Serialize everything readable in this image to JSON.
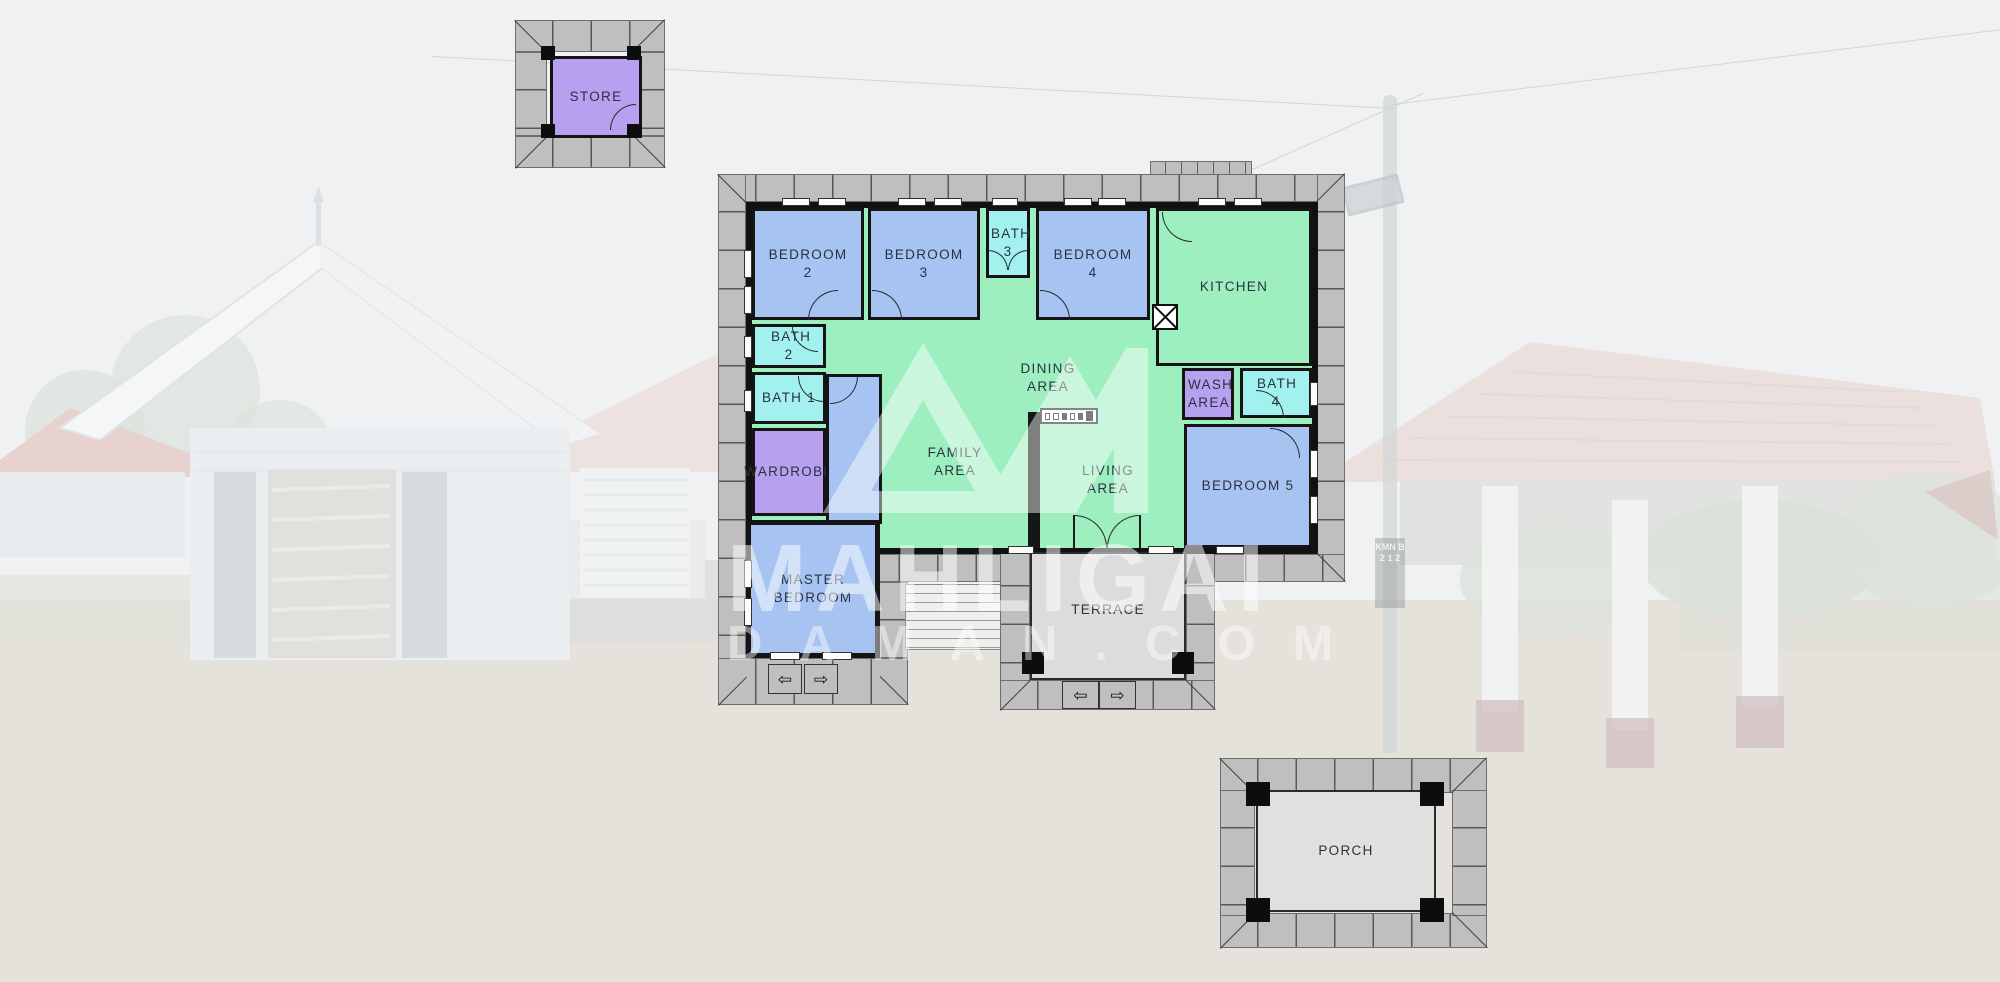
{
  "colors": {
    "bedroom": "#a6c3f2",
    "bath": "#a2f1ee",
    "purple": "#b7a0ef",
    "green": "#9defbf",
    "roof": "#bfbfbf",
    "floor": "#dcdcdc",
    "wall": "#141414"
  },
  "watermark": {
    "brand": "MAHLIGAI",
    "site": "DAMAN.COM"
  },
  "background": {
    "pole_sign": "KMN B 2 1 2"
  },
  "icons": {
    "arrow_left": "⇦",
    "arrow_right": "⇨"
  },
  "floorplan": {
    "store": "STORE",
    "bedroom2": "BEDROOM 2",
    "bedroom3": "BEDROOM 3",
    "bath3": "BATH 3",
    "bedroom4": "BEDROOM 4",
    "kitchen": "KITCHEN",
    "bath2": "BATH 2",
    "bath1": "BATH 1",
    "wardrobe": "WARDROBE",
    "master": "MASTER BEDROOM",
    "family": "FAMILY AREA",
    "dining": "DINING AREA",
    "living": "LIVING AREA",
    "wash": "WASH AREA",
    "bath4": "BATH 4",
    "bedroom5": "BEDROOM 5",
    "terrace": "TERRACE",
    "porch": "PORCH"
  }
}
